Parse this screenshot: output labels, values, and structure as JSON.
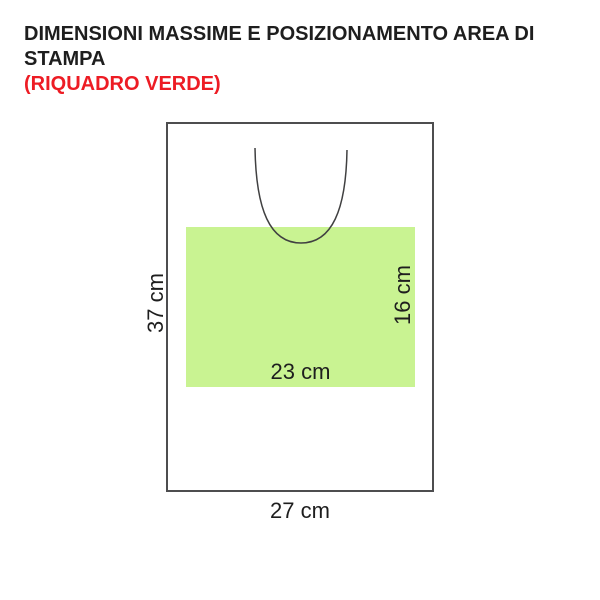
{
  "title": {
    "line1": "DIMENSIONI MASSIME E POSIZIONAMENTO AREA DI STAMPA",
    "line2": "(RIQUADRO VERDE)"
  },
  "colors": {
    "title_text": "#1e1e1e",
    "title_accent": "#ed1c24",
    "bag_outline": "#4d4d4f",
    "handle_line": "#404041",
    "print_area_fill": "#c9f392",
    "label_text": "#1e1e1e"
  },
  "diagram": {
    "bag_width_label": "27 cm",
    "bag_height_label": "37 cm",
    "print_area_width_label": "23 cm",
    "print_area_height_label": "16 cm"
  }
}
